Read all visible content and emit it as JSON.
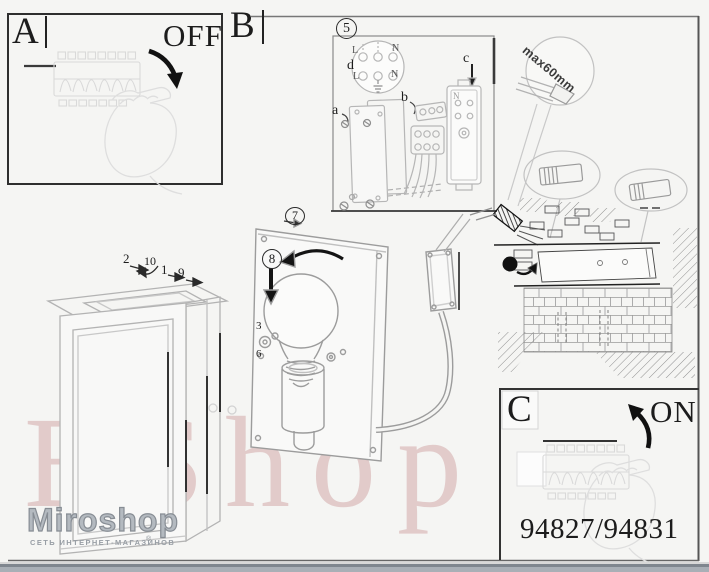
{
  "panels": {
    "a": {
      "label": "A",
      "status": "OFF"
    },
    "b": {
      "label": "B"
    },
    "c": {
      "label": "C",
      "status": "ON",
      "models": "94827/94831"
    }
  },
  "steps": {
    "wiring": "5",
    "cover": "7",
    "bulb": "8"
  },
  "callouts": {
    "one": "1",
    "two": "2",
    "three": "3",
    "six": "6",
    "nine": "9",
    "ten": "10"
  },
  "wiring": {
    "screw_a": "a",
    "connector_b": "b",
    "box_c": "c",
    "detail_d": "d",
    "live_top": "L",
    "neutral_top": "N",
    "live_bottom": "L",
    "neutral_bottom": "N",
    "box_terminal": "N"
  },
  "notes": {
    "max_cable_strip": "max60mm"
  },
  "watermarks": {
    "brand": "BShop",
    "store": "Miroshop",
    "tagline": "СЕТЬ ИНТЕРНЕТ-МАГАЗИНОВ",
    "reg": "®"
  }
}
